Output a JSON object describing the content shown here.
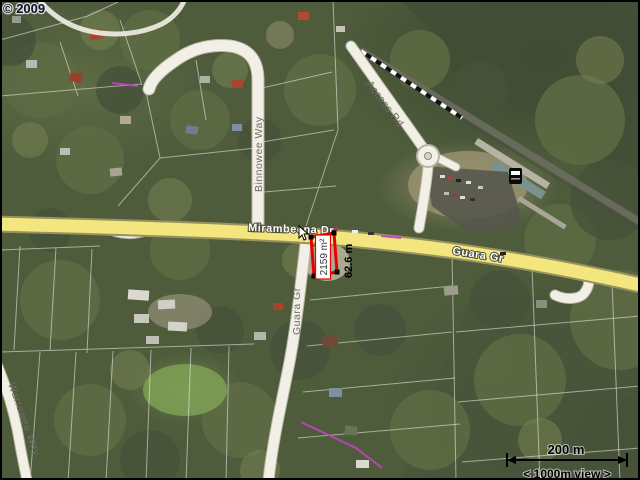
{
  "map": {
    "copyright": "© 2009",
    "road_labels": {
      "mirambeena_dr": "Mirambeena Dr",
      "guara_gr_east": "Guara Gr",
      "guara_gr_south": "Guara Gr",
      "binnowee_way": "Binnowee Way",
      "access_rd": "Access Rd",
      "warrawee_way": "Warrawee Way"
    },
    "measurement": {
      "area": "2159 m²",
      "width": "62.6 m"
    },
    "scale_bar": {
      "distance": "200 m",
      "view": "< 1000m view >"
    },
    "colors": {
      "highlight_red": "#e60000",
      "major_road_yellow": "#f4e67e",
      "survey_magenta": "#c83fc8"
    },
    "icons": {
      "train_station": "train-station-icon",
      "measure_cursor": "measure-cursor-icon"
    }
  }
}
